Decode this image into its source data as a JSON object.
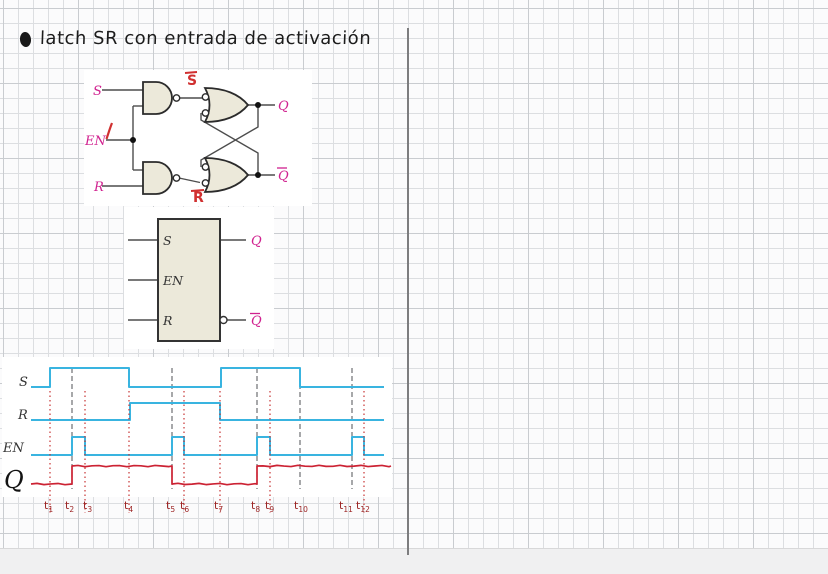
{
  "page": {
    "title": "latch SR con entrada de activación",
    "bullet_glyph": "filled-oval"
  },
  "colors": {
    "signal_cyan": "#39b4e0",
    "ink_red": "#c83434",
    "label_magenta": "#d0218f",
    "annotation_red": "#d03030",
    "gate_fill": "#ece9da",
    "time_label_red": "#9c2424"
  },
  "circuit": {
    "s": "S",
    "en": "EN",
    "r": "R",
    "q": "Q",
    "qbar": "Q",
    "sbar": "S",
    "rbar": "R",
    "en_value": "1"
  },
  "block": {
    "s": "S",
    "en": "EN",
    "r": "R",
    "q": "Q",
    "qbar": "Q"
  },
  "chart_data": {
    "type": "line",
    "subtype": "digital-timing",
    "title": "",
    "xlabel": "",
    "ylabel": "",
    "signals": [
      {
        "name": "S",
        "color": "#39b4e0",
        "label_style": "print",
        "label_x": 19,
        "label_y": 29,
        "high_y": 11,
        "low_y": 30,
        "start_x": 31,
        "end_x": 384,
        "initial": 0,
        "toggles_x": [
          50,
          129,
          221,
          300
        ]
      },
      {
        "name": "R",
        "color": "#39b4e0",
        "label_style": "print",
        "label_x": 18,
        "label_y": 62,
        "high_y": 46,
        "low_y": 63,
        "start_x": 31,
        "end_x": 384,
        "initial": 0,
        "toggles_x": [
          130,
          220
        ]
      },
      {
        "name": "EN",
        "color": "#39b4e0",
        "label_style": "print",
        "label_x": 3,
        "label_y": 95,
        "high_y": 80,
        "low_y": 98,
        "start_x": 31,
        "end_x": 384,
        "initial": 0,
        "toggles_x": [
          72,
          85,
          172,
          184,
          257,
          270,
          352,
          364
        ]
      },
      {
        "name": "Q",
        "color": "#cc2233",
        "label_style": "hand",
        "label_x": 4,
        "label_y": 131,
        "high_y": 109,
        "low_y": 127,
        "start_x": 31,
        "end_x": 391,
        "initial": 0,
        "hand": true,
        "toggles_x": [
          72,
          172,
          257
        ]
      }
    ],
    "cursors": {
      "dashed_x": [
        72,
        172,
        257,
        300,
        352
      ],
      "dotted_x": [
        50,
        85,
        129,
        184,
        220,
        270,
        364
      ],
      "dashed_color": "#5f6165",
      "dotted_color": "#c83434"
    },
    "time_labels": [
      {
        "base": "t",
        "sub": "1",
        "x": 44
      },
      {
        "base": "t",
        "sub": "2",
        "x": 65
      },
      {
        "base": "t",
        "sub": "3",
        "x": 83
      },
      {
        "base": "t",
        "sub": "4",
        "x": 124
      },
      {
        "base": "t",
        "sub": "5",
        "x": 166
      },
      {
        "base": "t",
        "sub": "6",
        "x": 180
      },
      {
        "base": "t",
        "sub": "7",
        "x": 214
      },
      {
        "base": "t",
        "sub": "8",
        "x": 251
      },
      {
        "base": "t",
        "sub": "9",
        "x": 265
      },
      {
        "base": "t",
        "sub": "10",
        "x": 294
      },
      {
        "base": "t",
        "sub": "11",
        "x": 339
      },
      {
        "base": "t",
        "sub": "12",
        "x": 356
      }
    ],
    "label_color": "#9c2424",
    "legend": "none",
    "grid": "off"
  }
}
